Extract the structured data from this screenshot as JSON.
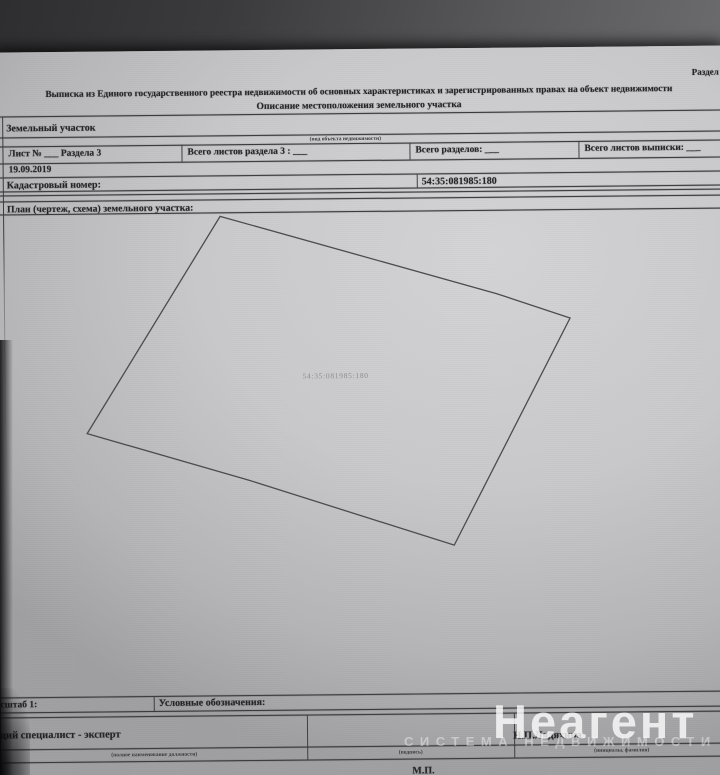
{
  "colors": {
    "paper": "#c9c9cb",
    "background": "#3b3b3d",
    "ink": "#242426",
    "watermark": "#ffffff"
  },
  "header": {
    "corner_label": "Раздел",
    "title_line1": "Выписка из Единого государственного реестра недвижимости об основных характеристиках и зарегистрированных правах на объект недвижимости",
    "title_line2": "Описание местоположения земельного участка"
  },
  "object_info": {
    "type": "Земельный участок",
    "type_hint": "(вид объекта недвижимости)",
    "sheet_label": "Лист № ___  Раздела 3",
    "sheets_in_section_label": "Всего листов раздела 3 : ___",
    "sections_total_label": "Всего разделов: ___",
    "sheets_total_label": "Всего листов выписки: ___",
    "date": "19.09.2019",
    "cadastral_label": "Кадастровый номер:",
    "cadastral_number": "54:35:081985:180"
  },
  "plan": {
    "section_title": "План (чертеж, схема) земельного участка:",
    "parcel_label": "54:35:081985:180",
    "polygon_points": "224,4 500,84 573,109 455,335 250,268 89,220"
  },
  "footer": {
    "scale_label": "Масштаб 1:",
    "legend_label": "Условные обозначения:",
    "position_title": "Ведущий специалист - эксперт",
    "position_hint": "(полное наименование должности)",
    "signature_hint": "(подпись)",
    "name": "Н.П.Лядяхина",
    "name_hint": "(инициалы, фамилия)",
    "stamp_label": "М.П."
  },
  "watermark": {
    "brand": "Неагент",
    "tagline": "СИСТЕМА НЕДВИЖИМОСТИ"
  }
}
